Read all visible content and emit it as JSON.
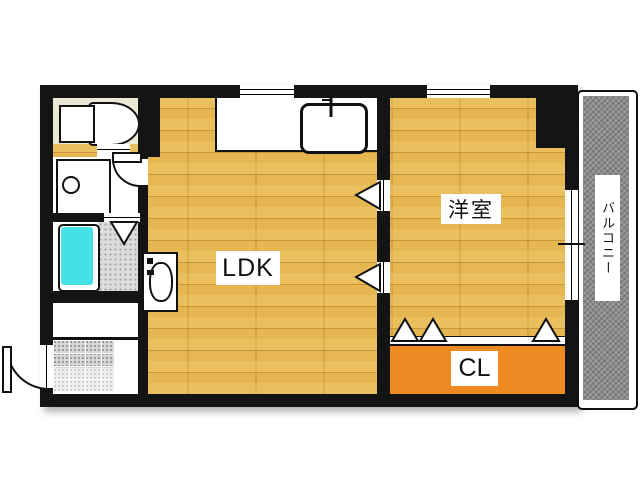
{
  "plan_title": "1LDK apartment floor plan",
  "rooms": {
    "ldk": {
      "label": "LDK"
    },
    "western": {
      "label": "洋室"
    },
    "closet": {
      "label": "CL"
    },
    "balcony": {
      "label": "バルコニー"
    }
  },
  "fixtures": [
    "toilet",
    "washing-machine-pan",
    "bathtub",
    "shower-floor",
    "kitchen-counter",
    "kitchen-sink",
    "washbasin",
    "entrance-tiles",
    "entrance-door",
    "washroom-door",
    "folding-bath-door",
    "sliding-door-markers",
    "closet-door-markers",
    "windows"
  ],
  "colors": {
    "wall": "#141414",
    "floor": "#e6b751",
    "closet": "#ed8a21",
    "bathtub": "#46e1e6",
    "toilet_room": "#ebe9d3",
    "balcony": "#8e8e8e",
    "shower": "#dcdcdc",
    "tile": "#d7d7d7"
  }
}
